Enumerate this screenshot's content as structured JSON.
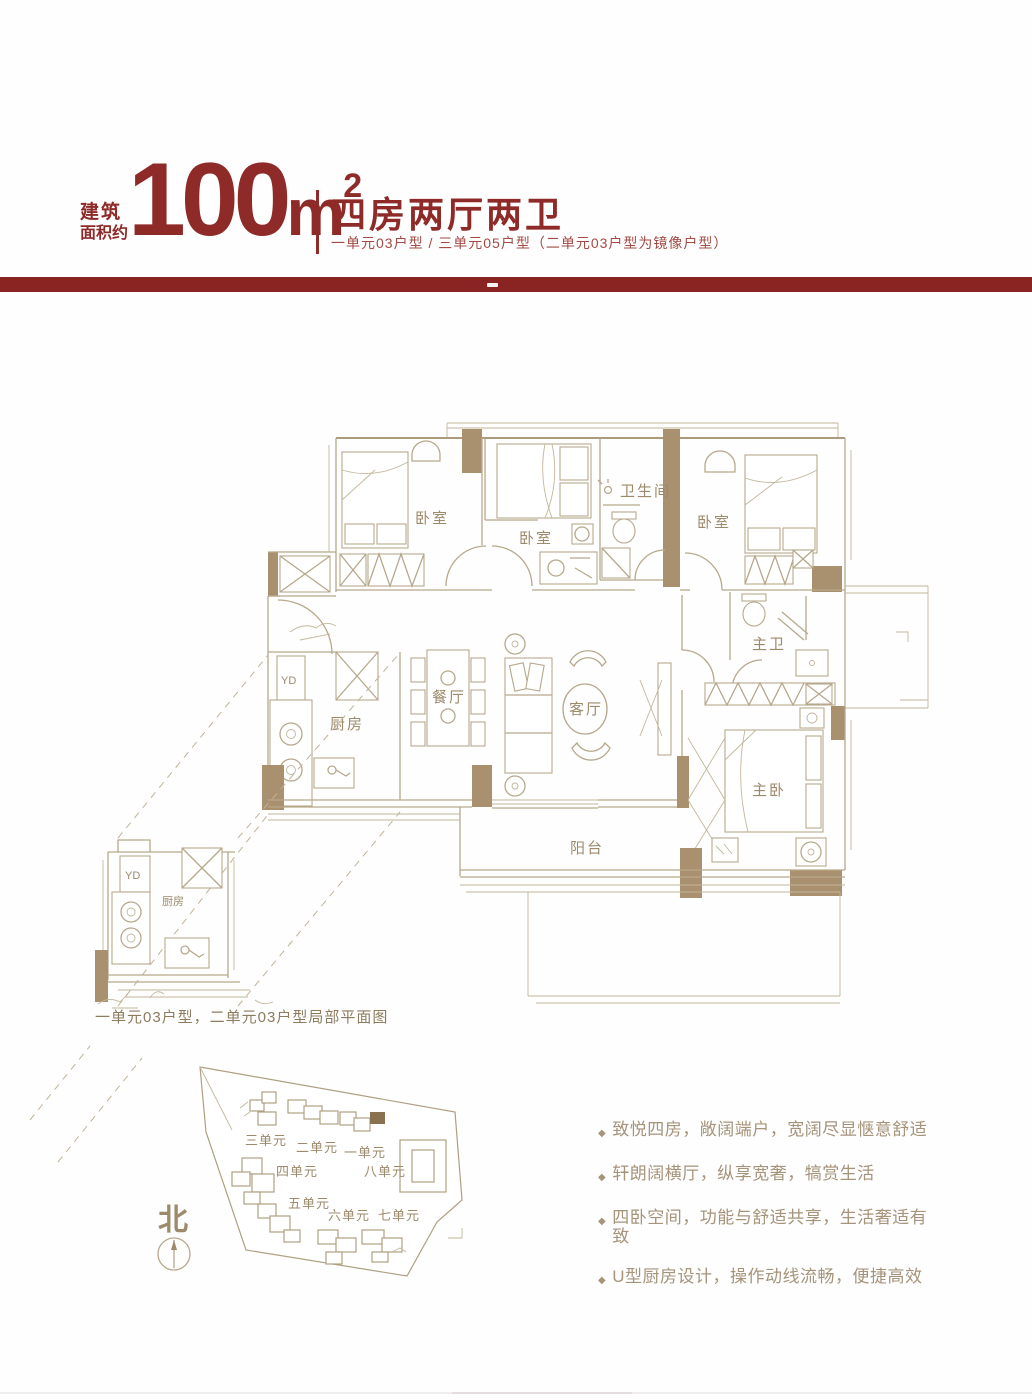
{
  "header": {
    "prefix_line1": "建筑",
    "prefix_line2": "面积约",
    "area_value": "100",
    "area_unit": "m",
    "area_sup": "2",
    "title": "四房两厅两卫",
    "subtitle": "一单元03户型 / 三单元05户型（二单元03户型为镜像户型）"
  },
  "colors": {
    "accent_red": "#8e2a27",
    "bar_red": "#8a2423",
    "line_tan": "#b7a88c",
    "wall_tan": "#a9906e",
    "label_tan": "#9c8a6b"
  },
  "floorplan": {
    "rooms": {
      "bedroom1": "卧室",
      "bedroom2": "卧室",
      "bath": "卫生间",
      "bedroom3": "卧室",
      "master_bath": "主卫",
      "dining": "餐厅",
      "living": "客厅",
      "kitchen": "厨房",
      "master": "主卧",
      "balcony": "阳台",
      "yd": "YD"
    }
  },
  "partial_plan": {
    "yd": "YD",
    "kitchen": "厨房",
    "caption": "一单元03户型，二单元03户型局部平面图"
  },
  "site_map": {
    "north_label": "北",
    "units": [
      {
        "label": "三单元"
      },
      {
        "label": "二单元"
      },
      {
        "label": "一单元"
      },
      {
        "label": "四单元"
      },
      {
        "label": "八单元"
      },
      {
        "label": "五单元"
      },
      {
        "label": "六单元"
      },
      {
        "label": "七单元"
      }
    ]
  },
  "features": [
    {
      "text": "致悦四房，敞阔端户，宽阔尽显惬意舒适"
    },
    {
      "text": "轩朗阔横厅，纵享宽奢，犒赏生活"
    },
    {
      "text": "四卧空间，功能与舒适共享，生活奢适有致"
    },
    {
      "text": "U型厨房设计，操作动线流畅，便捷高效"
    }
  ]
}
